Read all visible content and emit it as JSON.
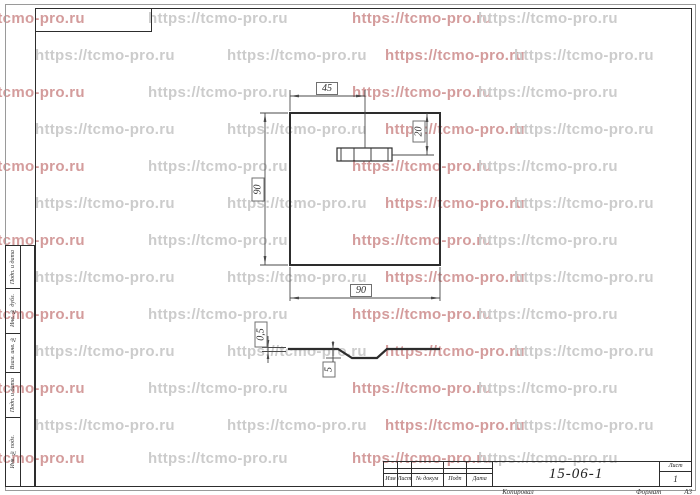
{
  "watermark": {
    "text": "https://tcmo-pro.ru",
    "gray_color": "#cccccc",
    "red_color": "#d49c9c"
  },
  "drawing": {
    "dims": {
      "slot_center_offset": "45",
      "slot_top_offset": "20",
      "plate_height": "90",
      "plate_width": "90",
      "sheet_thickness": "0,5",
      "emboss_depth": "5"
    }
  },
  "sidebar": {
    "labels": [
      "Подп. и дата",
      "Инв. № дубл.",
      "Взам. инв. №",
      "Подп. и дата",
      "Инв. № подл."
    ]
  },
  "title_block": {
    "columns": [
      "Изм",
      "Лист",
      "№ докум",
      "Подп",
      "Дата"
    ],
    "designation": "15-06-1",
    "sheet_label": "Лист",
    "sheet_number": "1",
    "copied_label": "Копировал",
    "format_label": "Формат",
    "format_value": "А3"
  }
}
